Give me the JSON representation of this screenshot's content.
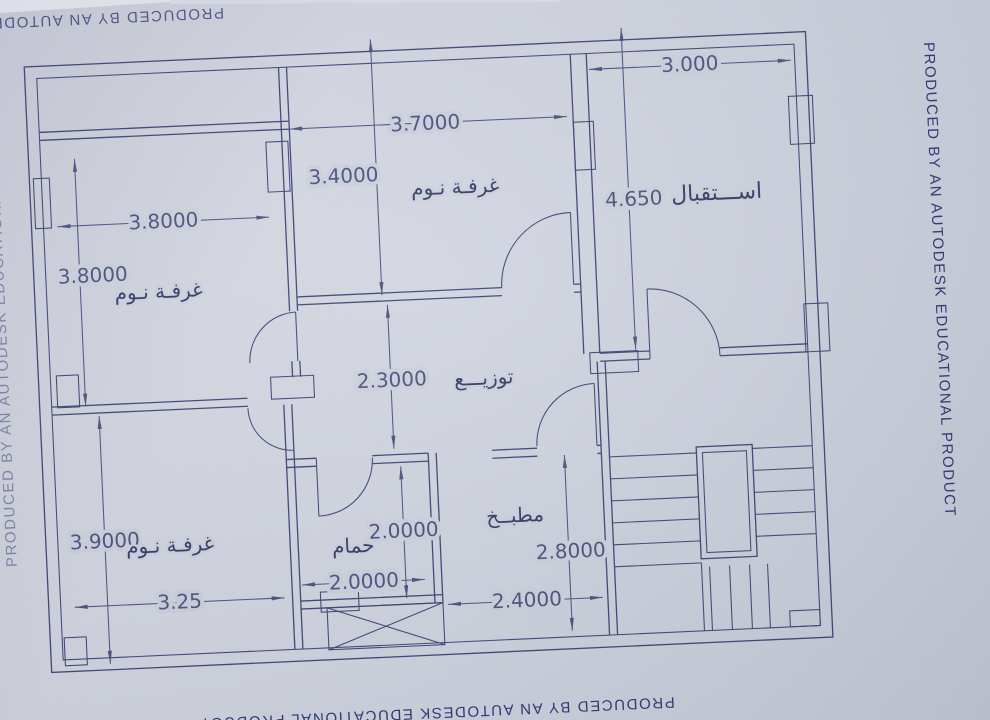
{
  "watermarks": {
    "right": "PRODUCED BY AN AUTODESK EDUCATIONAL PRODUCT",
    "bottom": "PRODUCED BY AN AUTODESK EDUCATIONAL PRODUCT",
    "top": "PRODUCED BY AN AUTODESK EDUCATIONAL PRODUCT",
    "left": "PRODUCED BY AN AUTODESK EDUCATIONAL PRODUCT"
  },
  "rooms": {
    "bedroom_top": {
      "label": "غرفـة نـوم"
    },
    "bedroom_left": {
      "label": "غرفـة نـوم"
    },
    "bedroom_bottom": {
      "label": "غرفـة نـوم"
    },
    "reception": {
      "label": "اســـتقبال"
    },
    "hall": {
      "label": "توزيـــع"
    },
    "bathroom": {
      "label": "حمام"
    },
    "kitchen": {
      "label": "مطبــخ"
    }
  },
  "dimensions": {
    "top_bedroom_width": "3.7000",
    "top_bedroom_height": "3.4000",
    "reception_width": "3.000",
    "reception_height": "4.650",
    "left_bedroom_width": "3.8000",
    "left_bedroom_height": "3.8000",
    "hall_height": "2.3000",
    "bottom_bedroom_height": "3.9000",
    "bottom_bedroom_width": "3.25",
    "bathroom_height": "2.0000",
    "bathroom_width": "2.0000",
    "kitchen_height": "2.8000",
    "kitchen_width": "2.4000"
  },
  "colors": {
    "ink": "#3d4473",
    "paper": "#ccd0dc",
    "watermark": "#2c3672"
  }
}
